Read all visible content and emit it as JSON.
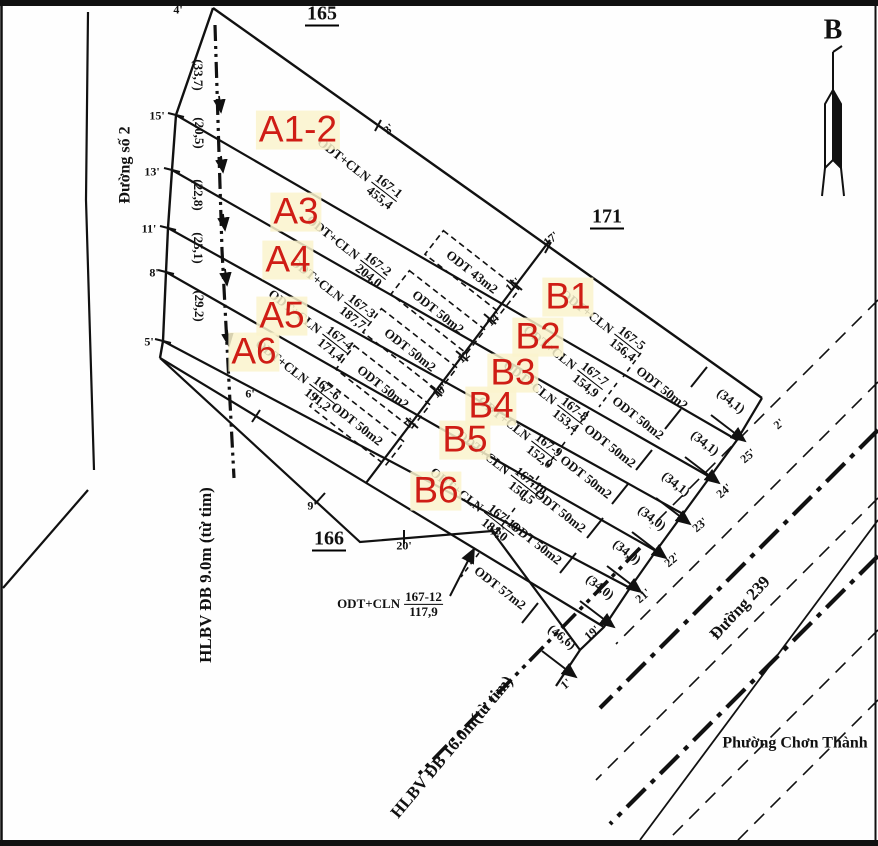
{
  "north_label": "B",
  "blocks": [
    "165",
    "171",
    "166"
  ],
  "streets": {
    "left_road": "Đường số 2",
    "right_road": "Đường 239",
    "ward": "Phường Chơn Thành",
    "corridor_left": "HLBV ĐB 9.0m (từ tim)",
    "corridor_bottom": "HLBV ĐB 16.0m(từ tim)"
  },
  "lots": [
    {
      "tag": "A1-2",
      "use": "ODT+CLN",
      "parcel": "167-1",
      "area": "455,4"
    },
    {
      "tag": "A3",
      "use": "ODT+CLN",
      "parcel": "167-2",
      "area": "204,0"
    },
    {
      "tag": "A4",
      "use": "ODT+CLN",
      "parcel": "167-3",
      "area": "187,7"
    },
    {
      "tag": "A5",
      "use": "ODT+CLN",
      "parcel": "167-4",
      "area": "171,4"
    },
    {
      "tag": "A6",
      "use": "ODT+CLN",
      "parcel": "167-6",
      "area": "191,2"
    },
    {
      "tag": "B1",
      "use": "ODT+CLN",
      "parcel": "167-5",
      "area": "156,4"
    },
    {
      "tag": "B2",
      "use": "ODT+CLN",
      "parcel": "167-7",
      "area": "154,9"
    },
    {
      "tag": "B3",
      "use": "ODT+CLN",
      "parcel": "167-8",
      "area": "153,4"
    },
    {
      "tag": "B4",
      "use": "ODT+CLN",
      "parcel": "167-9",
      "area": "152,0"
    },
    {
      "tag": "B5",
      "use": "ODT+CLN",
      "parcel": "167-10",
      "area": "150,5"
    },
    {
      "tag": "B6",
      "use": "ODT+CLN",
      "parcel": "167-11",
      "area": "184,0"
    },
    {
      "tag": "",
      "use": "ODT+CLN",
      "parcel": "167-12",
      "area": "117,9"
    }
  ],
  "odt_boxes": [
    "ODT 43m2",
    "ODT 50m2",
    "ODT 50m2",
    "ODT 50m2",
    "ODT 50m2"
  ],
  "odt_strips": [
    "ODT 50m2",
    "ODT 50m2",
    "ODT 50m2",
    "ODT 50m2",
    "ODT 50m2",
    "ODT 50m2",
    "ODT 57m2"
  ],
  "dims_left": [
    "(33,7)",
    "(20,5)",
    "(22,8)",
    "(25,1)",
    "(29,2)"
  ],
  "dims_right": [
    "(34,1)",
    "(34,1)",
    "(34,1)",
    "(34,0)",
    "(34,0)",
    "(34,0)",
    "(46,6)"
  ],
  "ticks_left": [
    "4'",
    "15'",
    "13'",
    "11'",
    "8'",
    "5'",
    "6'",
    "9'",
    "20'",
    "18'"
  ],
  "ticks_mid": [
    "3'",
    "17'",
    "16'",
    "14'",
    "12'",
    "10'",
    "7'"
  ],
  "ticks_right": [
    "2'",
    "25'",
    "24'",
    "23'",
    "22'",
    "21'",
    "19'",
    "1'"
  ],
  "colors": {
    "ink": "#111111",
    "lot_red": "#cf1d15",
    "highlight": "#faf3cd"
  }
}
